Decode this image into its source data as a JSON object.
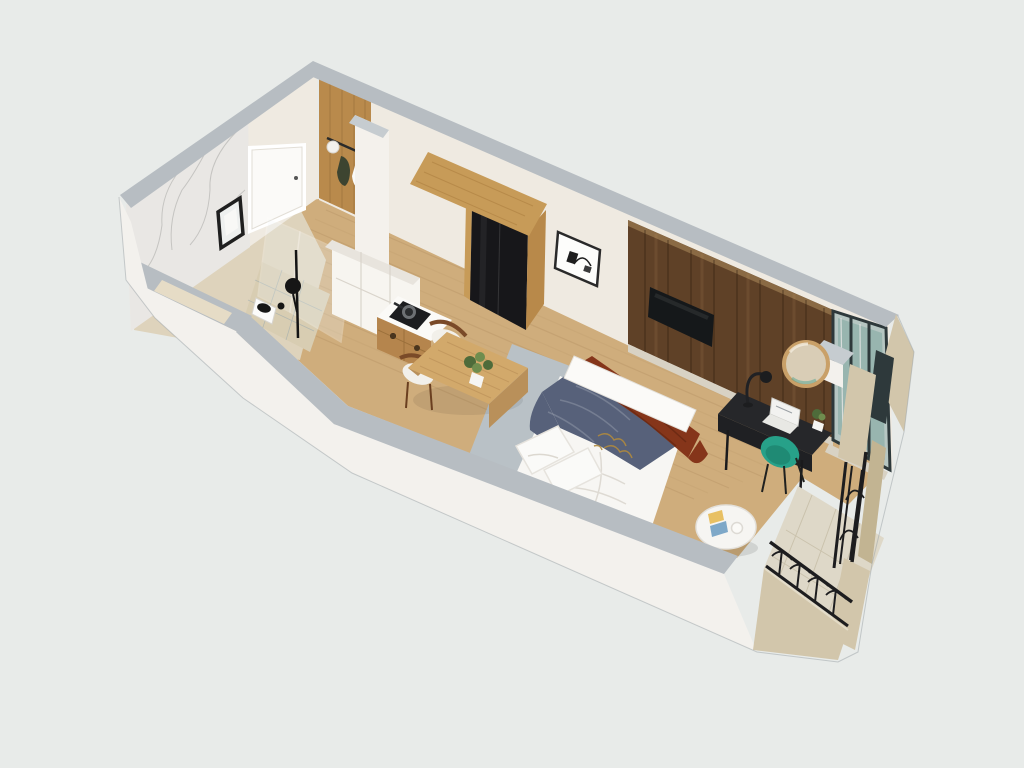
{
  "meta": {
    "view": "isometric-3d-floorplan-render",
    "canvas_width": 1024,
    "canvas_height": 768
  },
  "palette": {
    "bg": "#e8ebe9",
    "wall_top": "#b7bdc2",
    "wall_top_light": "#c6ccd0",
    "wall_cream": "#efeae1",
    "wall_white": "#f3f1ed",
    "marble": "#e9e7e4",
    "wood_floor": "#cfad7c",
    "plank_line": "#a8855a",
    "tile_bath": "#ded3bc",
    "shower_tile": "#d8cdb2",
    "rug": "#b9c1c6",
    "entry_wood": "#b98a4c",
    "coat_dark": "#3d4430",
    "partition_white": "#f4f1ec",
    "cabinet_white": "#f7f5f0",
    "cabinet_top": "#e8e4dd",
    "counter_white": "#fbfaf7",
    "cooktop_black": "#1c1d1f",
    "pan_gray": "#6d7073",
    "drawer_wood": "#b5854d",
    "table_wood": "#d2a96b",
    "table_side": "#b9905a",
    "chair_wood": "#7a4a28",
    "seat_white": "#f2f0ea",
    "wardrobe_wood": "#c79b58",
    "wardrobe_side": "#b8894a",
    "wardrobe_black": "#17171a",
    "art_white": "#fdfdfb",
    "accent_wood": "#5f4127",
    "accent_top": "#8a6a44",
    "tv_black": "#15181a",
    "mirror_wood": "#c9a068",
    "mirror_glass": "#d9cdb6",
    "desk_black": "#26272a",
    "desk_front": "#1f2023",
    "laptop_white": "#f2f2f0",
    "laptop_base": "#e8e8e4",
    "chair_teal": "#27a189",
    "chair_teal_dark": "#1f8a74",
    "bed_white": "#f7f6f3",
    "headboard_white": "#fbfaf8",
    "blanket_navy": "#57617a",
    "throw_rust": "#85351a",
    "gold": "#b08a3e",
    "pillow_white": "#fafaf8",
    "coffee_white": "#f6f5f2",
    "book_gold": "#e8c063",
    "book_blue": "#7ea8c8",
    "stone": "#d2c6ab",
    "stone_dark": "#c2b492",
    "balcony_tile": "#ded8c8",
    "railing_black": "#1d1d1f",
    "glass_frame": "#2e393b",
    "glass_base": "#b6c6c2",
    "glass_teal": "#7fa8a0",
    "sill": "#d8d2c4",
    "fixture_black": "#161616",
    "toilet_white": "#fbfbfa",
    "niche_beige": "#e6dcc6",
    "door_white": "#fbfaf8",
    "plant_green": "#4e6b3a",
    "plant_light": "#6f8d4e",
    "outline": "#9aa2a6"
  }
}
